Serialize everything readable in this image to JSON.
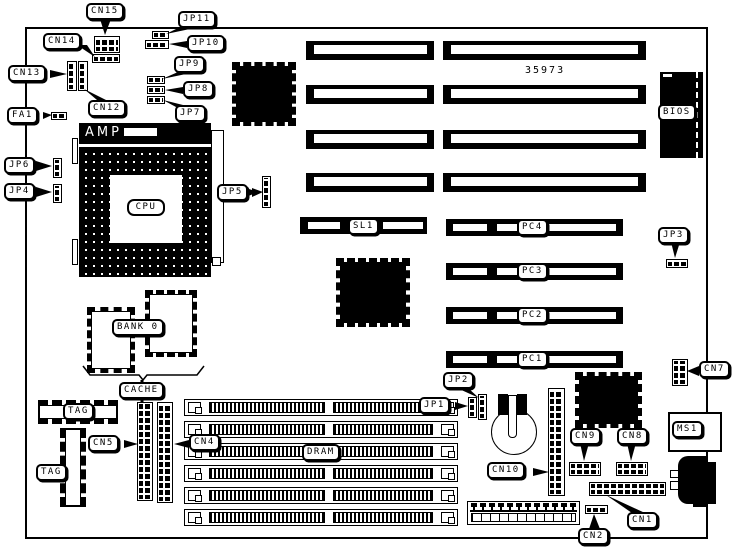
{
  "diagram": {
    "type": "motherboard-layout",
    "part_number": "35973",
    "colors": {
      "foreground": "#000000",
      "background": "#ffffff"
    },
    "labels": {
      "cn15": "CN15",
      "cn14": "CN14",
      "cn13": "CN13",
      "cn12": "CN12",
      "jp11": "JP11",
      "jp10": "JP10",
      "jp9": "JP9",
      "jp8": "JP8",
      "jp7": "JP7",
      "fa1": "FA1",
      "jp6": "JP6",
      "jp4": "JP4",
      "jp5": "JP5",
      "amp": "AMP",
      "cpu": "CPU",
      "bios": "BIOS",
      "sl1": "SL1",
      "pc4": "PC4",
      "pc3": "PC3",
      "pc2": "PC2",
      "pc1": "PC1",
      "jp3": "JP3",
      "cn7": "CN7",
      "bank0": "BANK 0",
      "cache": "CACHE",
      "tag_top": "TAG",
      "tag_left": "TAG",
      "cn5": "CN5",
      "cn4": "CN4",
      "dram": "DRAM",
      "jp2": "JP2",
      "jp1": "JP1",
      "cn10": "CN10",
      "cn9": "CN9",
      "cn8": "CN8",
      "ms1": "MS1",
      "cn1": "CN1",
      "cn2": "CN2"
    }
  }
}
